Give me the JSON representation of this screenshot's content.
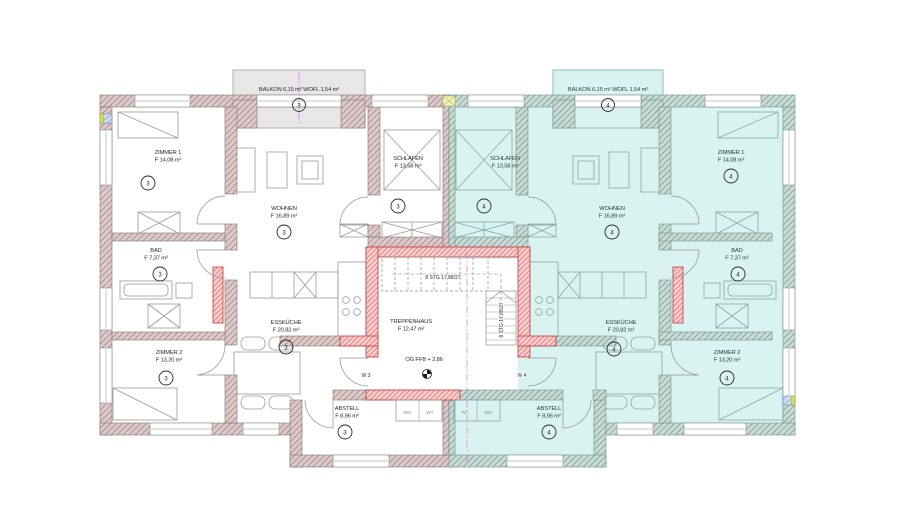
{
  "plan": {
    "colors": {
      "apartment4_fill": "#d9f3f1",
      "balcony3_fill": "#e8e6e6",
      "wall_masonry": "#dcc9c9",
      "wall_masonry_right": "#c9dbd6",
      "wall_new_red": "#f7cdcd",
      "red_line": "#c23b3b",
      "axis_magenta": "#e66ae6"
    },
    "apartment3": {
      "unit": "3",
      "balkon": "BALKON 6,15 m²  WOFL 1,54 m²",
      "zimmer1": {
        "name": "ZIMMER 1",
        "area": "F 14,08 m²"
      },
      "bad": {
        "name": "BAD",
        "area": "F 7,37 m²"
      },
      "zimmer2": {
        "name": "ZIMMER 2",
        "area": "F 13,20 m²"
      },
      "wohnen": {
        "name": "WOHNEN",
        "area": "F 16,89 m²"
      },
      "schlafen": {
        "name": "SCHLAFEN",
        "area": "F 13,58 m²"
      },
      "esskueche": {
        "name": "ESSKÜCHE",
        "area": "F 20,82 m²"
      },
      "abstell": {
        "name": "ABSTELL",
        "area": "F 8,96 m²"
      },
      "entry_door": "W 3",
      "closets": [
        "WM",
        "WT"
      ]
    },
    "apartment4": {
      "unit": "4",
      "balkon": "BALKON 6,15 m²  WOFL 1,54 m²",
      "zimmer1": {
        "name": "ZIMMER 1",
        "area": "F 14,08 m²"
      },
      "bad": {
        "name": "BAD",
        "area": "F 7,37 m²"
      },
      "zimmer2": {
        "name": "ZIMMER 2",
        "area": "F 13,20 m²"
      },
      "wohnen": {
        "name": "WOHNEN",
        "area": "F 16,89 m²"
      },
      "schlafen": {
        "name": "SCHLAFEN",
        "area": "F 13,58 m²"
      },
      "esskueche": {
        "name": "ESSKÜCHE",
        "area": "F 20,82 m²"
      },
      "abstell": {
        "name": "ABSTELL",
        "area": "F 8,96 m²"
      },
      "entry_door": "W 4",
      "closets": [
        "WT",
        "WM"
      ]
    },
    "treppenhaus": {
      "name": "TREPPENHAUS",
      "area": "F 12,47 m²",
      "stairs_upper": "8 STG 17,88/27",
      "stairs_lower": "8 STG 17,88/27",
      "level": "OG FFB + 2,86"
    }
  }
}
